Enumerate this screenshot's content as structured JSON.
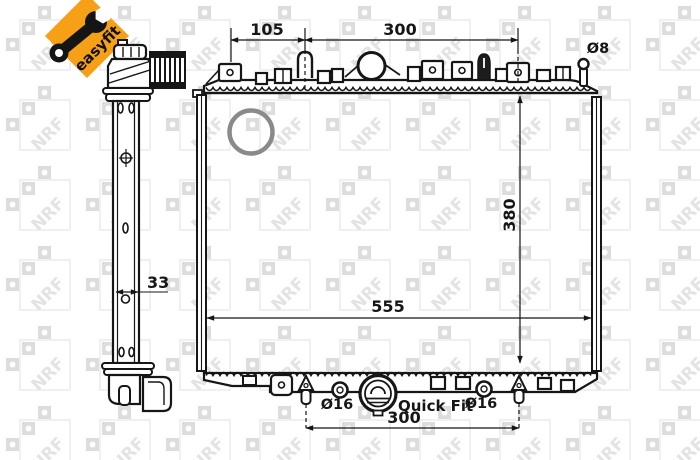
{
  "badge": {
    "label": "easyfit",
    "icon": "wrench-icon"
  },
  "watermark": {
    "text": "NRF"
  },
  "colors": {
    "badge_bg": "#F6A018",
    "line": "#161616",
    "ring": "#8a8a8a",
    "watermark_sq": "#d7d7d7",
    "watermark_outline": "#e7e7e7",
    "watermark_text": "#dedede"
  },
  "dimensions": {
    "top_left_span": "105",
    "top_right_span": "300",
    "pin_diameter": "Ø8",
    "core_height": "380",
    "core_width": "555",
    "side_depth": "33",
    "outlet_left_diameter": "Ø16",
    "outlet_right_diameter": "Ø16",
    "quick_fit_label": "Quick Fit",
    "bottom_span": "300"
  }
}
